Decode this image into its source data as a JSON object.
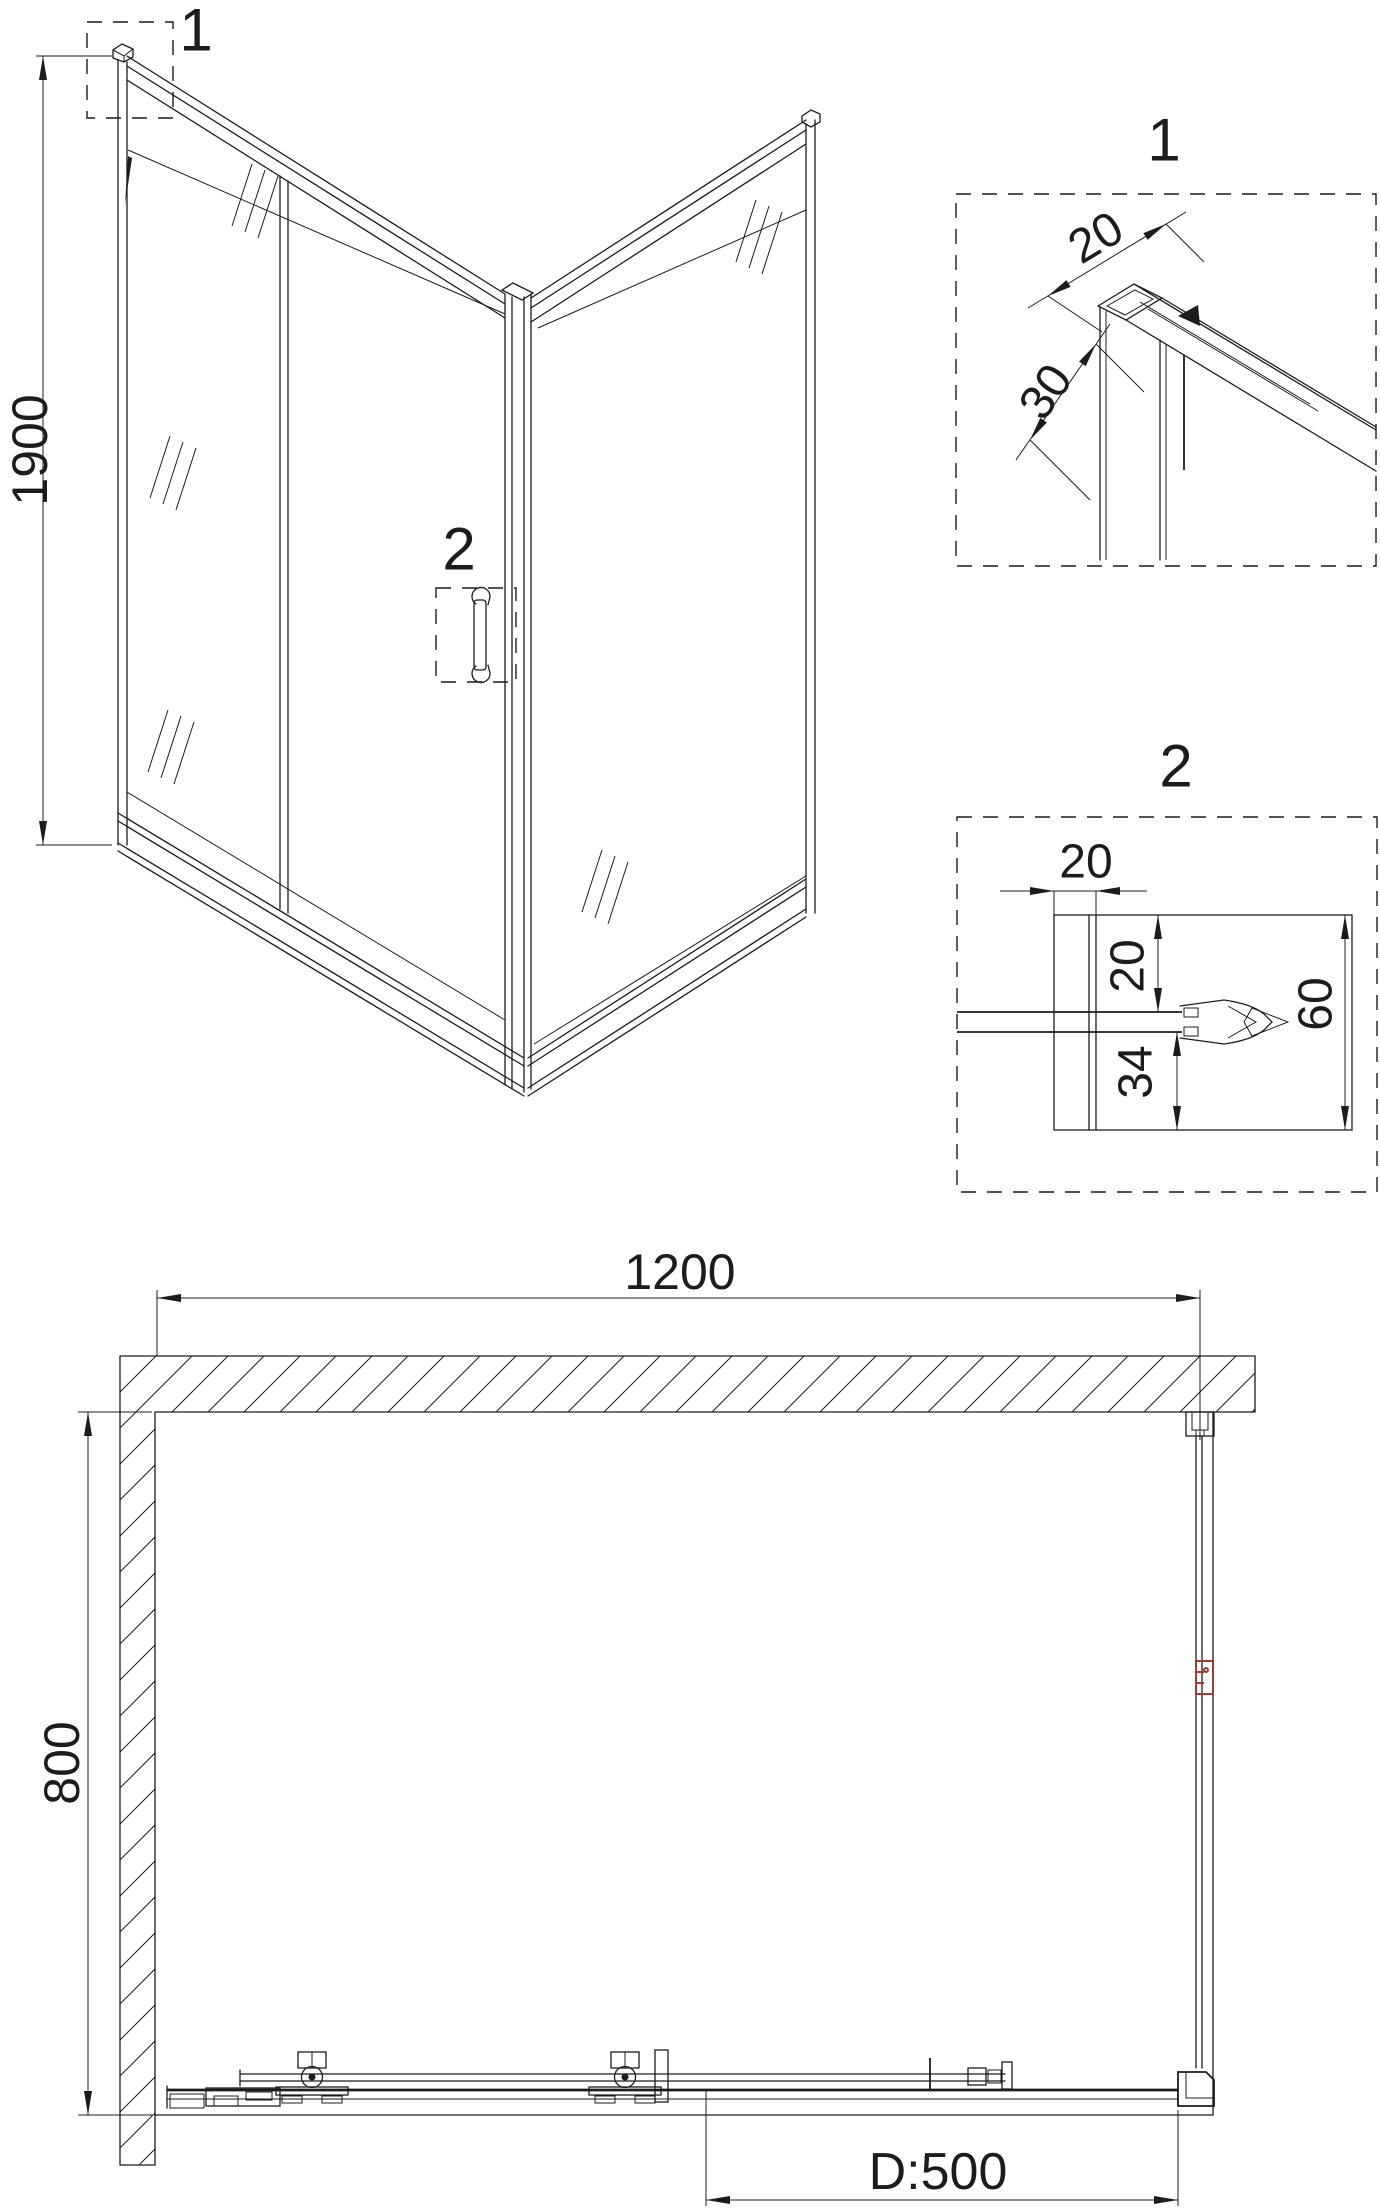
{
  "drawing_title": "shower-enclosure-technical-drawing",
  "colors": {
    "line": "#1c1c1c",
    "accent_red": "#a83a30",
    "background": "#ffffff"
  },
  "iso_view": {
    "callout_1": "1",
    "callout_2": "2",
    "height_dim": "1900"
  },
  "detail_1": {
    "label": "1",
    "profile_width_dim": "20",
    "profile_depth_dim": "30"
  },
  "detail_2": {
    "label": "2",
    "profile_width_dim": "20",
    "top_gap_dim": "20",
    "bottom_gap_dim": "34",
    "overall_depth_dim": "60"
  },
  "plan_view": {
    "width_dim": "1200",
    "depth_dim": "800",
    "door_opening_dim": "D:500"
  }
}
